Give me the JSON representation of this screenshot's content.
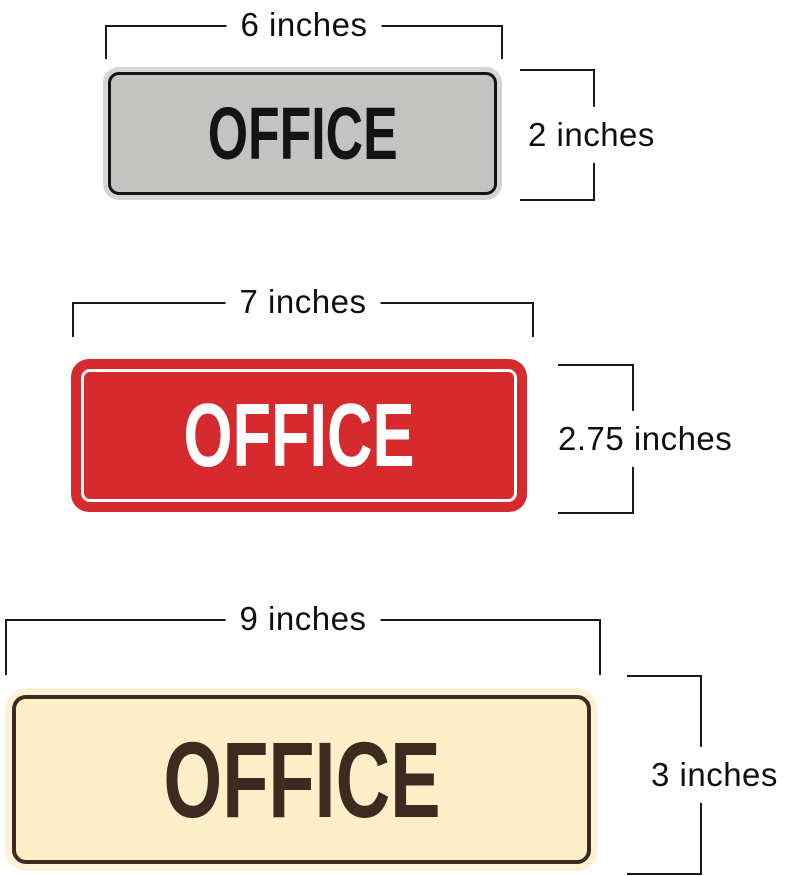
{
  "page": {
    "background": "#ffffff"
  },
  "dimension_style": {
    "line_color": "#1a1a1a",
    "text_color": "#0f0f0f"
  },
  "signs": [
    {
      "name": "office-sign-silver",
      "text": "OFFICE",
      "width_label": "6 inches",
      "height_label": "2 inches",
      "colors": {
        "rim": "#d5d6d4",
        "plate": "#c3c4c2",
        "border": "#141414",
        "text": "#141414"
      }
    },
    {
      "name": "office-sign-red",
      "text": "OFFICE",
      "width_label": "7 inches",
      "height_label": "2.75 inches",
      "colors": {
        "rim": "#d52b2f",
        "plate": "#d52b2f",
        "border": "#ffffff",
        "text": "#ffffff"
      }
    },
    {
      "name": "office-sign-cream",
      "text": "OFFICE",
      "width_label": "9 inches",
      "height_label": "3 inches",
      "colors": {
        "rim": "#fcf3d6",
        "plate": "#fdf0c8",
        "border": "#3e2a1f",
        "text": "#3e2a1f"
      }
    }
  ]
}
